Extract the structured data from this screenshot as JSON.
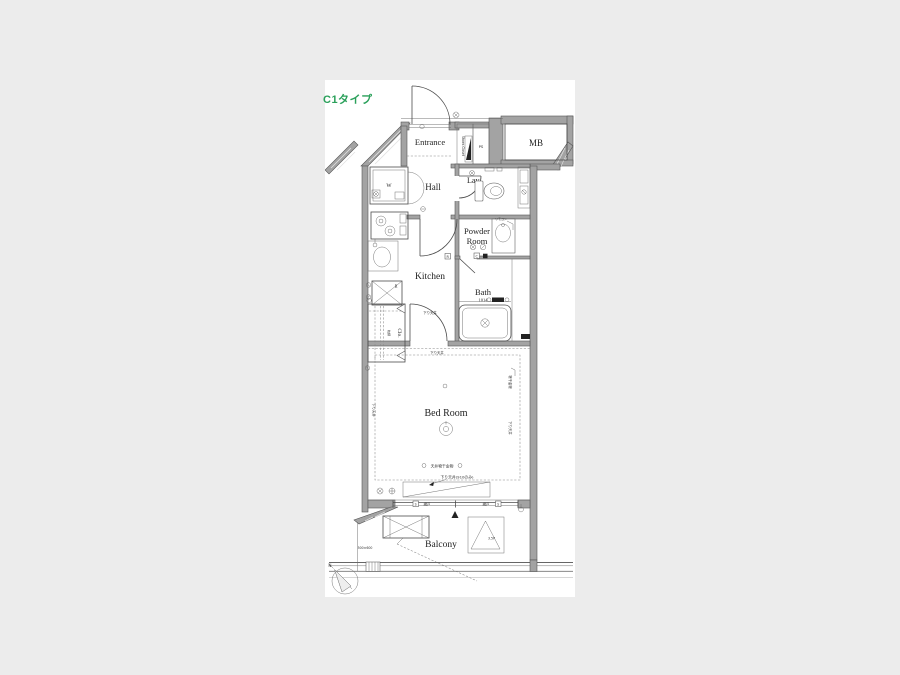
{
  "page": {
    "background": "#ececec",
    "panel_background": "#ffffff"
  },
  "header": {
    "type_label": "C1タイプ",
    "type_color": "#2aa05a"
  },
  "rooms": {
    "entrance": "Entrance",
    "mb": "MB",
    "ps": "PS",
    "shoes_closet": "Shoes Closet",
    "hall": "Hall",
    "lavatory": "Lav.",
    "powder_room_line1": "Powder",
    "powder_room_line2": "Room",
    "kitchen": "Kitchen",
    "bath": "Bath",
    "bath_size": "1014",
    "washer": "W",
    "refrigerator": "R",
    "closet": "Clo.",
    "bedroom": "Bed Room",
    "balcony": "Balcony"
  },
  "annotations": {
    "lowered_ceiling_kitchen_door": "下り天井",
    "lowered_ceiling_bedroom_top": "下り天井",
    "lowered_ceiling_left": "下り天井",
    "laundry_fitting_right": "物干金物",
    "lowered_ceiling_right": "下り天井",
    "ceiling_laundry_hardware": "天井物干金物",
    "lowered_ceiling_910": "下り天井(910のみ)",
    "screen_door_left": "網戸",
    "screen_door_right": "網戸",
    "screen_mark": "S",
    "shelf": "枕棚",
    "remote_control": "リモコン",
    "hatch_size": "500×600",
    "partition_mark": "3.5P",
    "finish_mark_c": "C",
    "finish_mark_r": "R",
    "north": "N"
  }
}
